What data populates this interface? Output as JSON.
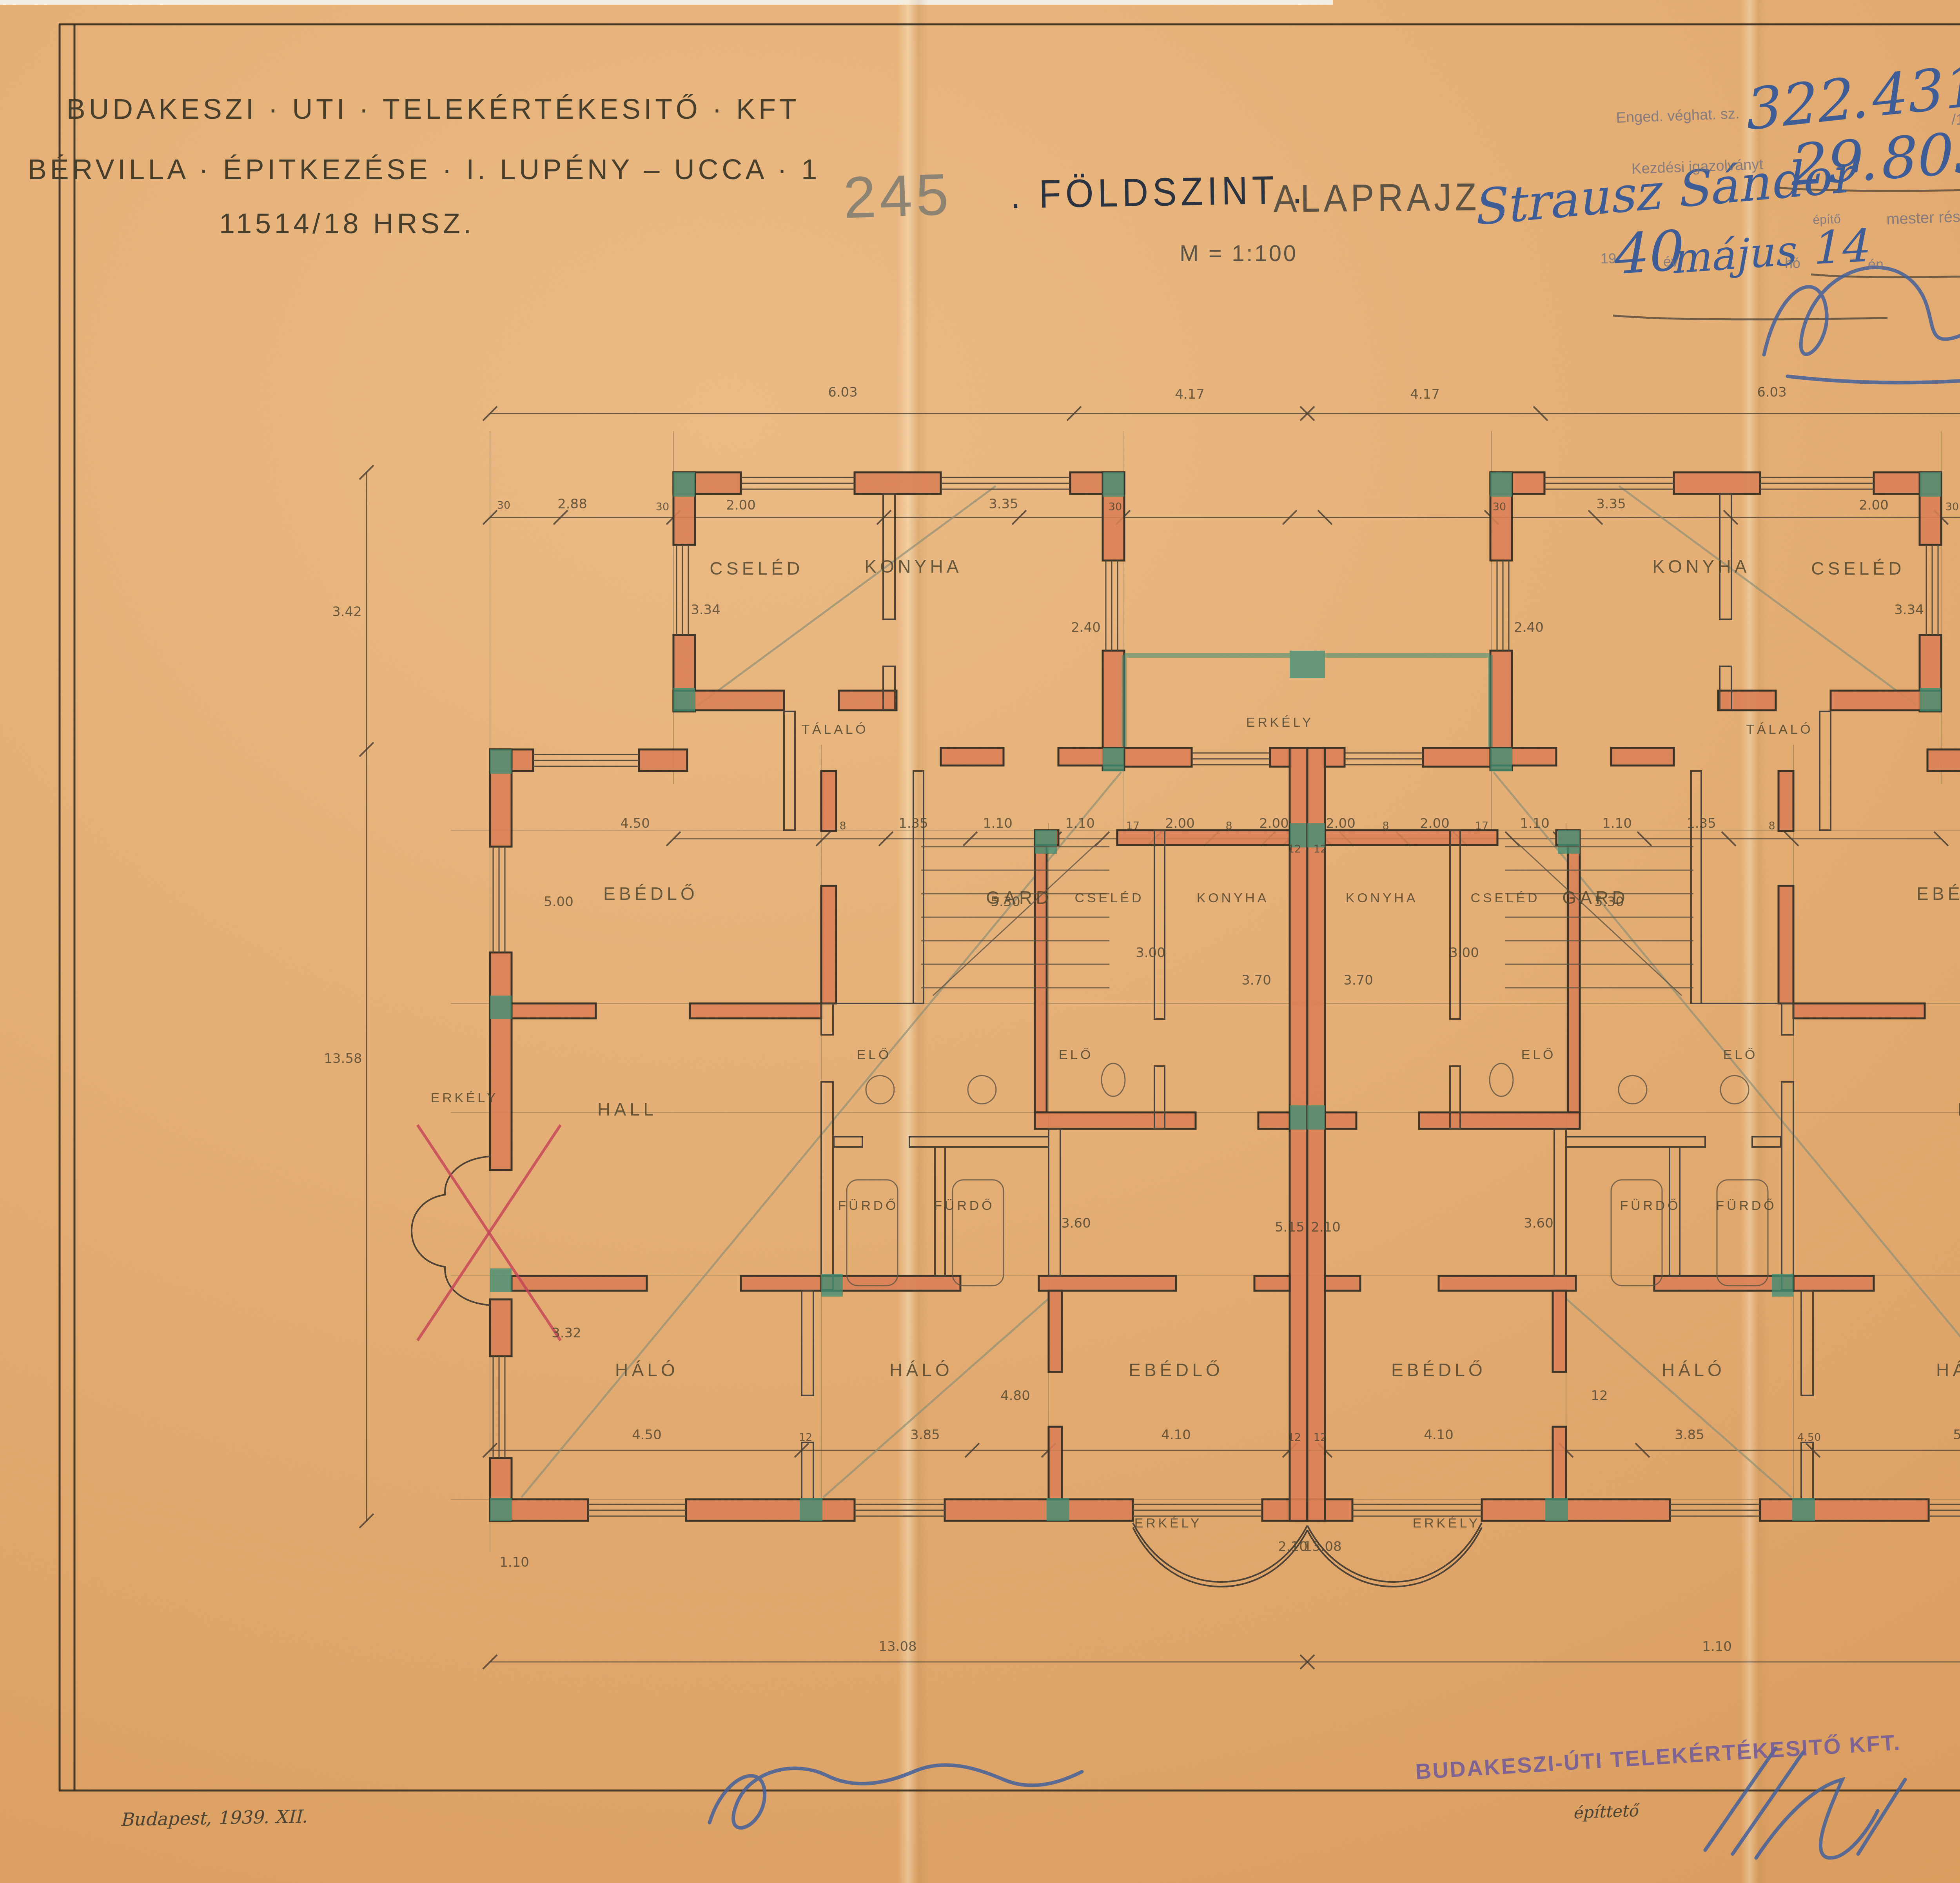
{
  "archive": {
    "name": "Budapest F\u0151v\u00e1ros Lev\u00e9lt\u00e1ra"
  },
  "header": {
    "line1": "BUDAKESZI \u00b7 UTI \u00b7 TELEK\u00c9RT\u00c9KESIT\u0150 \u00b7 KFT",
    "line2": "B\u00c9RVILLA \u00b7 \u00c9PITKEZ\u00c9SE \u00b7 I. LUP\u00c9NY \u2013 UCCA \u00b7 1",
    "line3": "11514/18 HRSZ.",
    "sheet_number": "245"
  },
  "title": {
    "part1": ". F\u00d6LDSZINT .",
    "part2": "ALAPRAJZ",
    "scale": "M = 1:100",
    "client_name": "Strausz S\u00e1ndor"
  },
  "stamp": {
    "l1a": "Enged. v\u00e9ghat. sz.",
    "l1_num": "322.431",
    "l1b": "/19",
    "l1_year": "39",
    "l1c": "III. \u00fc. o.",
    "l2a": "Kezd\u00e9si igazolv\u00e1nyt",
    "l2_num": "29.805",
    "l2b": "sz.",
    "l2c": "19",
    "l2_year": "40",
    "l2d": "ker. El\u00f6lj.",
    "l3a": "\u00e9p\u00edt\u0151",
    "l3b": "mester r\u00e9sz\u00e9re kiadta.",
    "l4a": "19",
    "l4_year": "40",
    "l4b": "\u00e9v",
    "l4_month": "m\u00e1jus",
    "l4c": "h\u00f3",
    "l4_day": "14",
    "l4d": "\u00e9n.",
    "signer": "ker. m\u00e9rn\u00f6k."
  },
  "footer": {
    "date": "Budapest, 1939. XII.",
    "owner_stamp": "BUDAKESZI-\u00daTI TELEK\u00c9RT\u00c9KESIT\u0150 KFT.",
    "owner_role": "\u00e9p\u00edttet\u0151",
    "architect": "FRIED MIKSA",
    "architect_title": "okl. \u00e9p\u00edt\u00e9szm\u00e9rn\u00f6k",
    "architect_line3": "a Budapesti M\u00e9rn\u00f6ki",
    "architect_role": "tervez\u0151"
  },
  "plan": {
    "rooms": [
      "CSEL\u00c9D",
      "KONYHA",
      "KONYHA",
      "CSEL\u00c9D",
      "T\u00c1LAL\u00d3",
      "T\u00c1LAL\u00d3",
      "ERK\u00c9LY",
      "EB\u00c9DL\u0150",
      "EB\u00c9DL\u0150",
      "GARD",
      "GARD",
      "CSEL\u00c9D",
      "KONYHA",
      "KONYHA",
      "CSEL\u00c9D",
      "EL\u0150",
      "EL\u0150",
      "EL\u0150",
      "EL\u0150",
      "HALL",
      "HALL",
      "F\u00dcRD\u0150",
      "F\u00dcRD\u0150",
      "F\u00dcRD\u0150",
      "F\u00dcRD\u0150",
      "H\u00c1L\u00d3",
      "H\u00c1L\u00d3",
      "EB\u00c9DL\u0150",
      "EB\u00c9DL\u0150",
      "H\u00c1L\u00d3",
      "H\u00c1L\u00d3",
      "ERK\u00c9LY",
      "ERK\u00c9LY",
      "ERK\u00c9LY",
      "ERK\u00c9LY"
    ],
    "dims": [
      "6.03",
      "4.17",
      "4.17",
      "6.03",
      "2.88",
      "30",
      "2.00",
      "3.35",
      "30",
      "30",
      "3.35",
      "2.00",
      "30",
      "2.88",
      "3.42",
      "13.58",
      "3.42",
      "13.58",
      "3.34",
      "2.40",
      "2.40",
      "3.34",
      "4.50",
      "8",
      "1.35",
      "1.10",
      "1.10",
      "17",
      "2.00",
      "8",
      "2.00",
      "12",
      "12",
      "2.00",
      "8",
      "2.00",
      "17",
      "1.10",
      "1.10",
      "1.35",
      "8",
      "4.50",
      "5.00",
      "5.30",
      "3.70",
      "3.70",
      "5.30",
      "5.00",
      "3.00",
      "3.00",
      "3.32",
      "3.32",
      "3.60",
      "3.60",
      "4.50",
      "12",
      "3.85",
      "4.80",
      "4.10",
      "12",
      "12",
      "4.10",
      "3.85",
      "12",
      "4.50",
      "5.15",
      "5.15",
      "2.10",
      "2.10",
      "13.08",
      "13.08",
      "1.10",
      "1.10",
      "30",
      "30"
    ]
  }
}
